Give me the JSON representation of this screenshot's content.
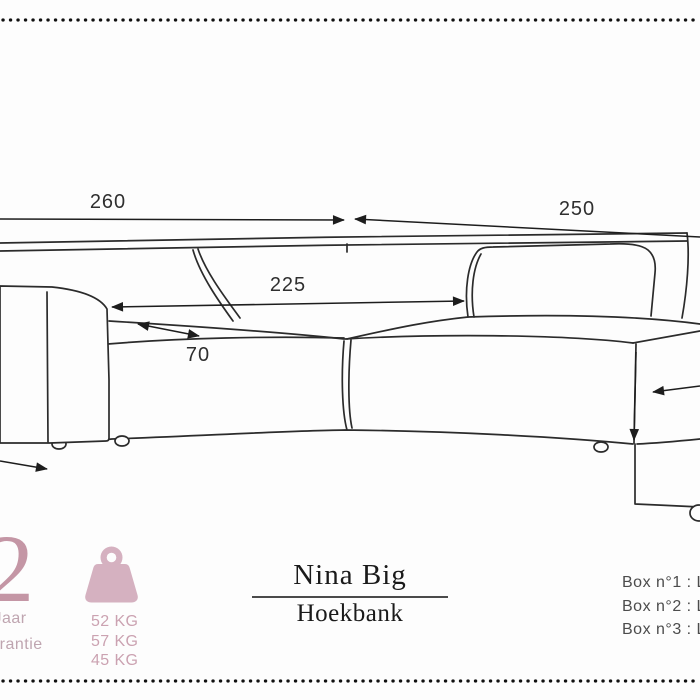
{
  "drawing": {
    "description": "corner sofa technical line drawing",
    "dim_total_width": "260",
    "dim_total_depth": "250",
    "dim_inner_width": "225",
    "dim_seat_depth": "70"
  },
  "warranty": {
    "years": "2",
    "unit": "Jaar",
    "label": "Garantie"
  },
  "weight": {
    "values": [
      "52 KG",
      "57 KG",
      "45 KG"
    ]
  },
  "product": {
    "name": "Nina Big",
    "subtitle": "Hoekbank"
  },
  "boxes": {
    "box1": "Box n°1 : L 1",
    "box2": "Box n°2 : L 1",
    "box3": "Box n°3 : L 1"
  },
  "colors": {
    "pink_number": "#c496a5",
    "pink_warranty_text": "#bfa5b0",
    "pink_icon": "#d5b1c0",
    "pink_kg_text": "#cba2b1",
    "drawing_line": "#2b2b2b",
    "dimension_text": "#2f2f2f",
    "title_text": "#1a1a1a",
    "box_text": "#4c4c4c"
  }
}
